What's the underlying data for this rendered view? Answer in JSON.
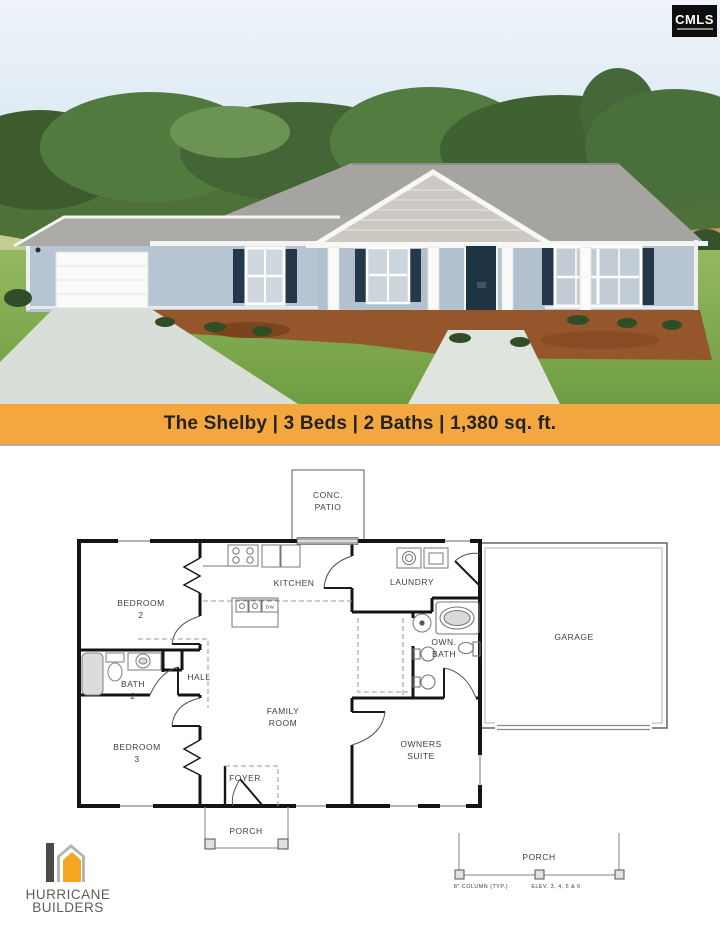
{
  "header": {
    "cmls": "CMLS"
  },
  "banner": {
    "full_text": "The Shelby | 3 Beds | 2 Baths | 1,380 sq. ft.",
    "bg_color": "#F4A63F",
    "text_color": "#232323"
  },
  "floor_plan": {
    "rooms": {
      "conc_patio": [
        "CONC.",
        "PATIO"
      ],
      "bedroom2": [
        "BEDROOM",
        "2"
      ],
      "kitchen": [
        "KITCHEN"
      ],
      "laundry": [
        "LAUNDRY"
      ],
      "own_bath": [
        "OWN.",
        "BATH"
      ],
      "garage": [
        "GARAGE"
      ],
      "bath2": [
        "BATH",
        "2"
      ],
      "hall": [
        "HALL"
      ],
      "family_room": [
        "FAMILY",
        "ROOM"
      ],
      "bedroom3": [
        "BEDROOM",
        "3"
      ],
      "owners_suite": [
        "OWNERS",
        "SUITE"
      ],
      "foyer": [
        "FOYER"
      ],
      "front_porch": [
        "PORCH"
      ],
      "rear_porch": [
        "PORCH"
      ]
    },
    "appliances": {
      "dishwasher": "DW"
    },
    "notes": {
      "column_note": "8\" COLUMN (TYP.)",
      "elevation_note": "ELEV. 3, 4, 5 & 6"
    }
  },
  "builder": {
    "line1": "HURRICANE",
    "line2": "BUILDERS",
    "logo_orange": "#F5A623",
    "logo_gray": "#b5b5b5",
    "logo_dark": "#4a4a48"
  },
  "photo_colors": {
    "siding": "#b7c5d3",
    "roof": "#a6a4a0",
    "door_navy": "#1f3443",
    "grass": "#7fa94e",
    "mulch": "#95562b"
  }
}
